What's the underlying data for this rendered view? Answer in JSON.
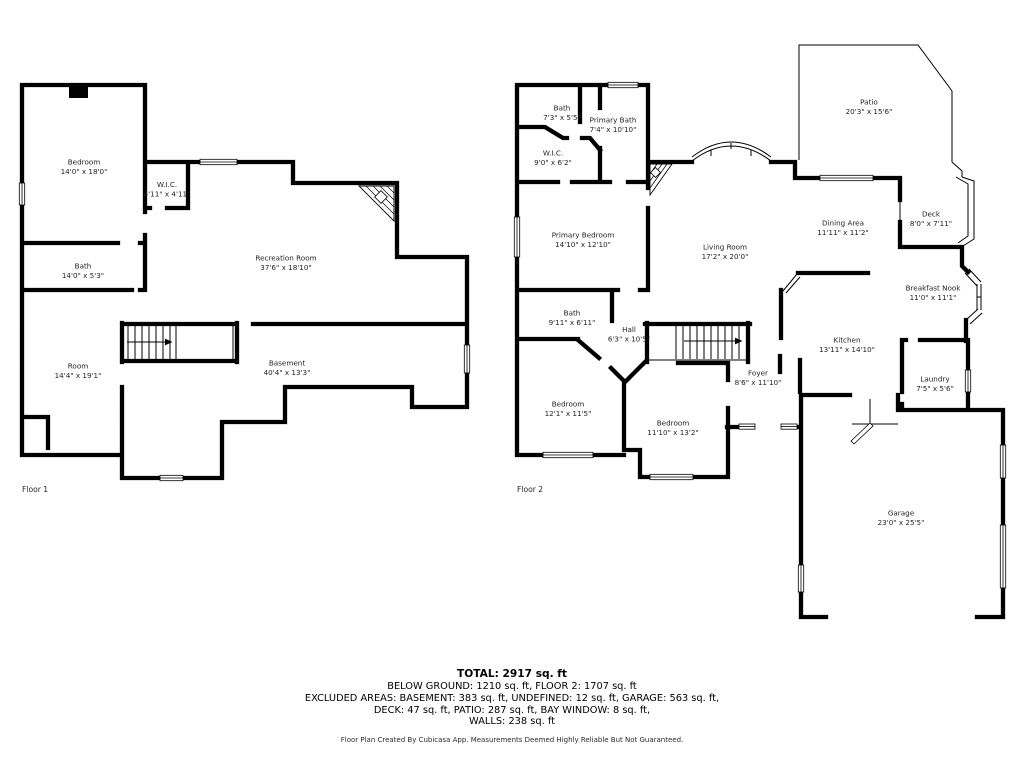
{
  "colors": {
    "wall": "#000000",
    "background": "#ffffff",
    "text": "#1f1f1f"
  },
  "floor1": {
    "label": "Floor 1",
    "rooms": {
      "bedroom": {
        "name": "Bedroom",
        "dims": "14'0\" x 18'0\""
      },
      "wic": {
        "name": "W.I.C.",
        "dims": "4'11\" x 4'11\""
      },
      "bath": {
        "name": "Bath",
        "dims": "14'0\" x 5'3\""
      },
      "recreation": {
        "name": "Recreation Room",
        "dims": "37'6\" x 18'10\""
      },
      "room": {
        "name": "Room",
        "dims": "14'4\" x 19'1\""
      },
      "basement": {
        "name": "Basement",
        "dims": "40'4\" x 13'3\""
      }
    }
  },
  "floor2": {
    "label": "Floor 2",
    "rooms": {
      "bath_top": {
        "name": "Bath",
        "dims": "7'3\" x 5'5\""
      },
      "primary_bath": {
        "name": "Primary Bath",
        "dims": "7'4\" x 10'10\""
      },
      "wic": {
        "name": "W.I.C.",
        "dims": "9'0\" x 6'2\""
      },
      "primary_bedroom": {
        "name": "Primary Bedroom",
        "dims": "14'10\" x 12'10\""
      },
      "living_room": {
        "name": "Living Room",
        "dims": "17'2\" x 20'0\""
      },
      "patio": {
        "name": "Patio",
        "dims": "20'3\" x 15'6\""
      },
      "dining_area": {
        "name": "Dining Area",
        "dims": "11'11\" x 11'2\""
      },
      "deck": {
        "name": "Deck",
        "dims": "8'0\" x 7'11\""
      },
      "breakfast_nook": {
        "name": "Breakfast Nook",
        "dims": "11'0\" x 11'1\""
      },
      "bath_mid": {
        "name": "Bath",
        "dims": "9'11\" x 6'11\""
      },
      "hall": {
        "name": "Hall",
        "dims": "6'3\" x 10'5\""
      },
      "kitchen": {
        "name": "Kitchen",
        "dims": "13'11\" x 14'10\""
      },
      "foyer": {
        "name": "Foyer",
        "dims": "8'6\" x 11'10\""
      },
      "laundry": {
        "name": "Laundry",
        "dims": "7'5\" x 5'6\""
      },
      "bedroom_left": {
        "name": "Bedroom",
        "dims": "12'1\" x 11'5\""
      },
      "bedroom_mid": {
        "name": "Bedroom",
        "dims": "11'10\" x 13'2\""
      },
      "garage": {
        "name": "Garage",
        "dims": "23'0\" x 25'5\""
      }
    }
  },
  "summary": {
    "total": "TOTAL: 2917 sq. ft",
    "line1": "BELOW GROUND: 1210 sq. ft, FLOOR 2: 1707 sq. ft",
    "line2": "EXCLUDED AREAS: BASEMENT: 383 sq. ft, UNDEFINED: 12 sq. ft, GARAGE: 563 sq. ft,",
    "line3": "DECK: 47 sq. ft, PATIO: 287 sq. ft, BAY WINDOW: 8 sq. ft,",
    "line4": "WALLS: 238 sq. ft"
  },
  "footer": "Floor Plan Created By Cubicasa App. Measurements Deemed Highly Reliable But Not Guaranteed."
}
